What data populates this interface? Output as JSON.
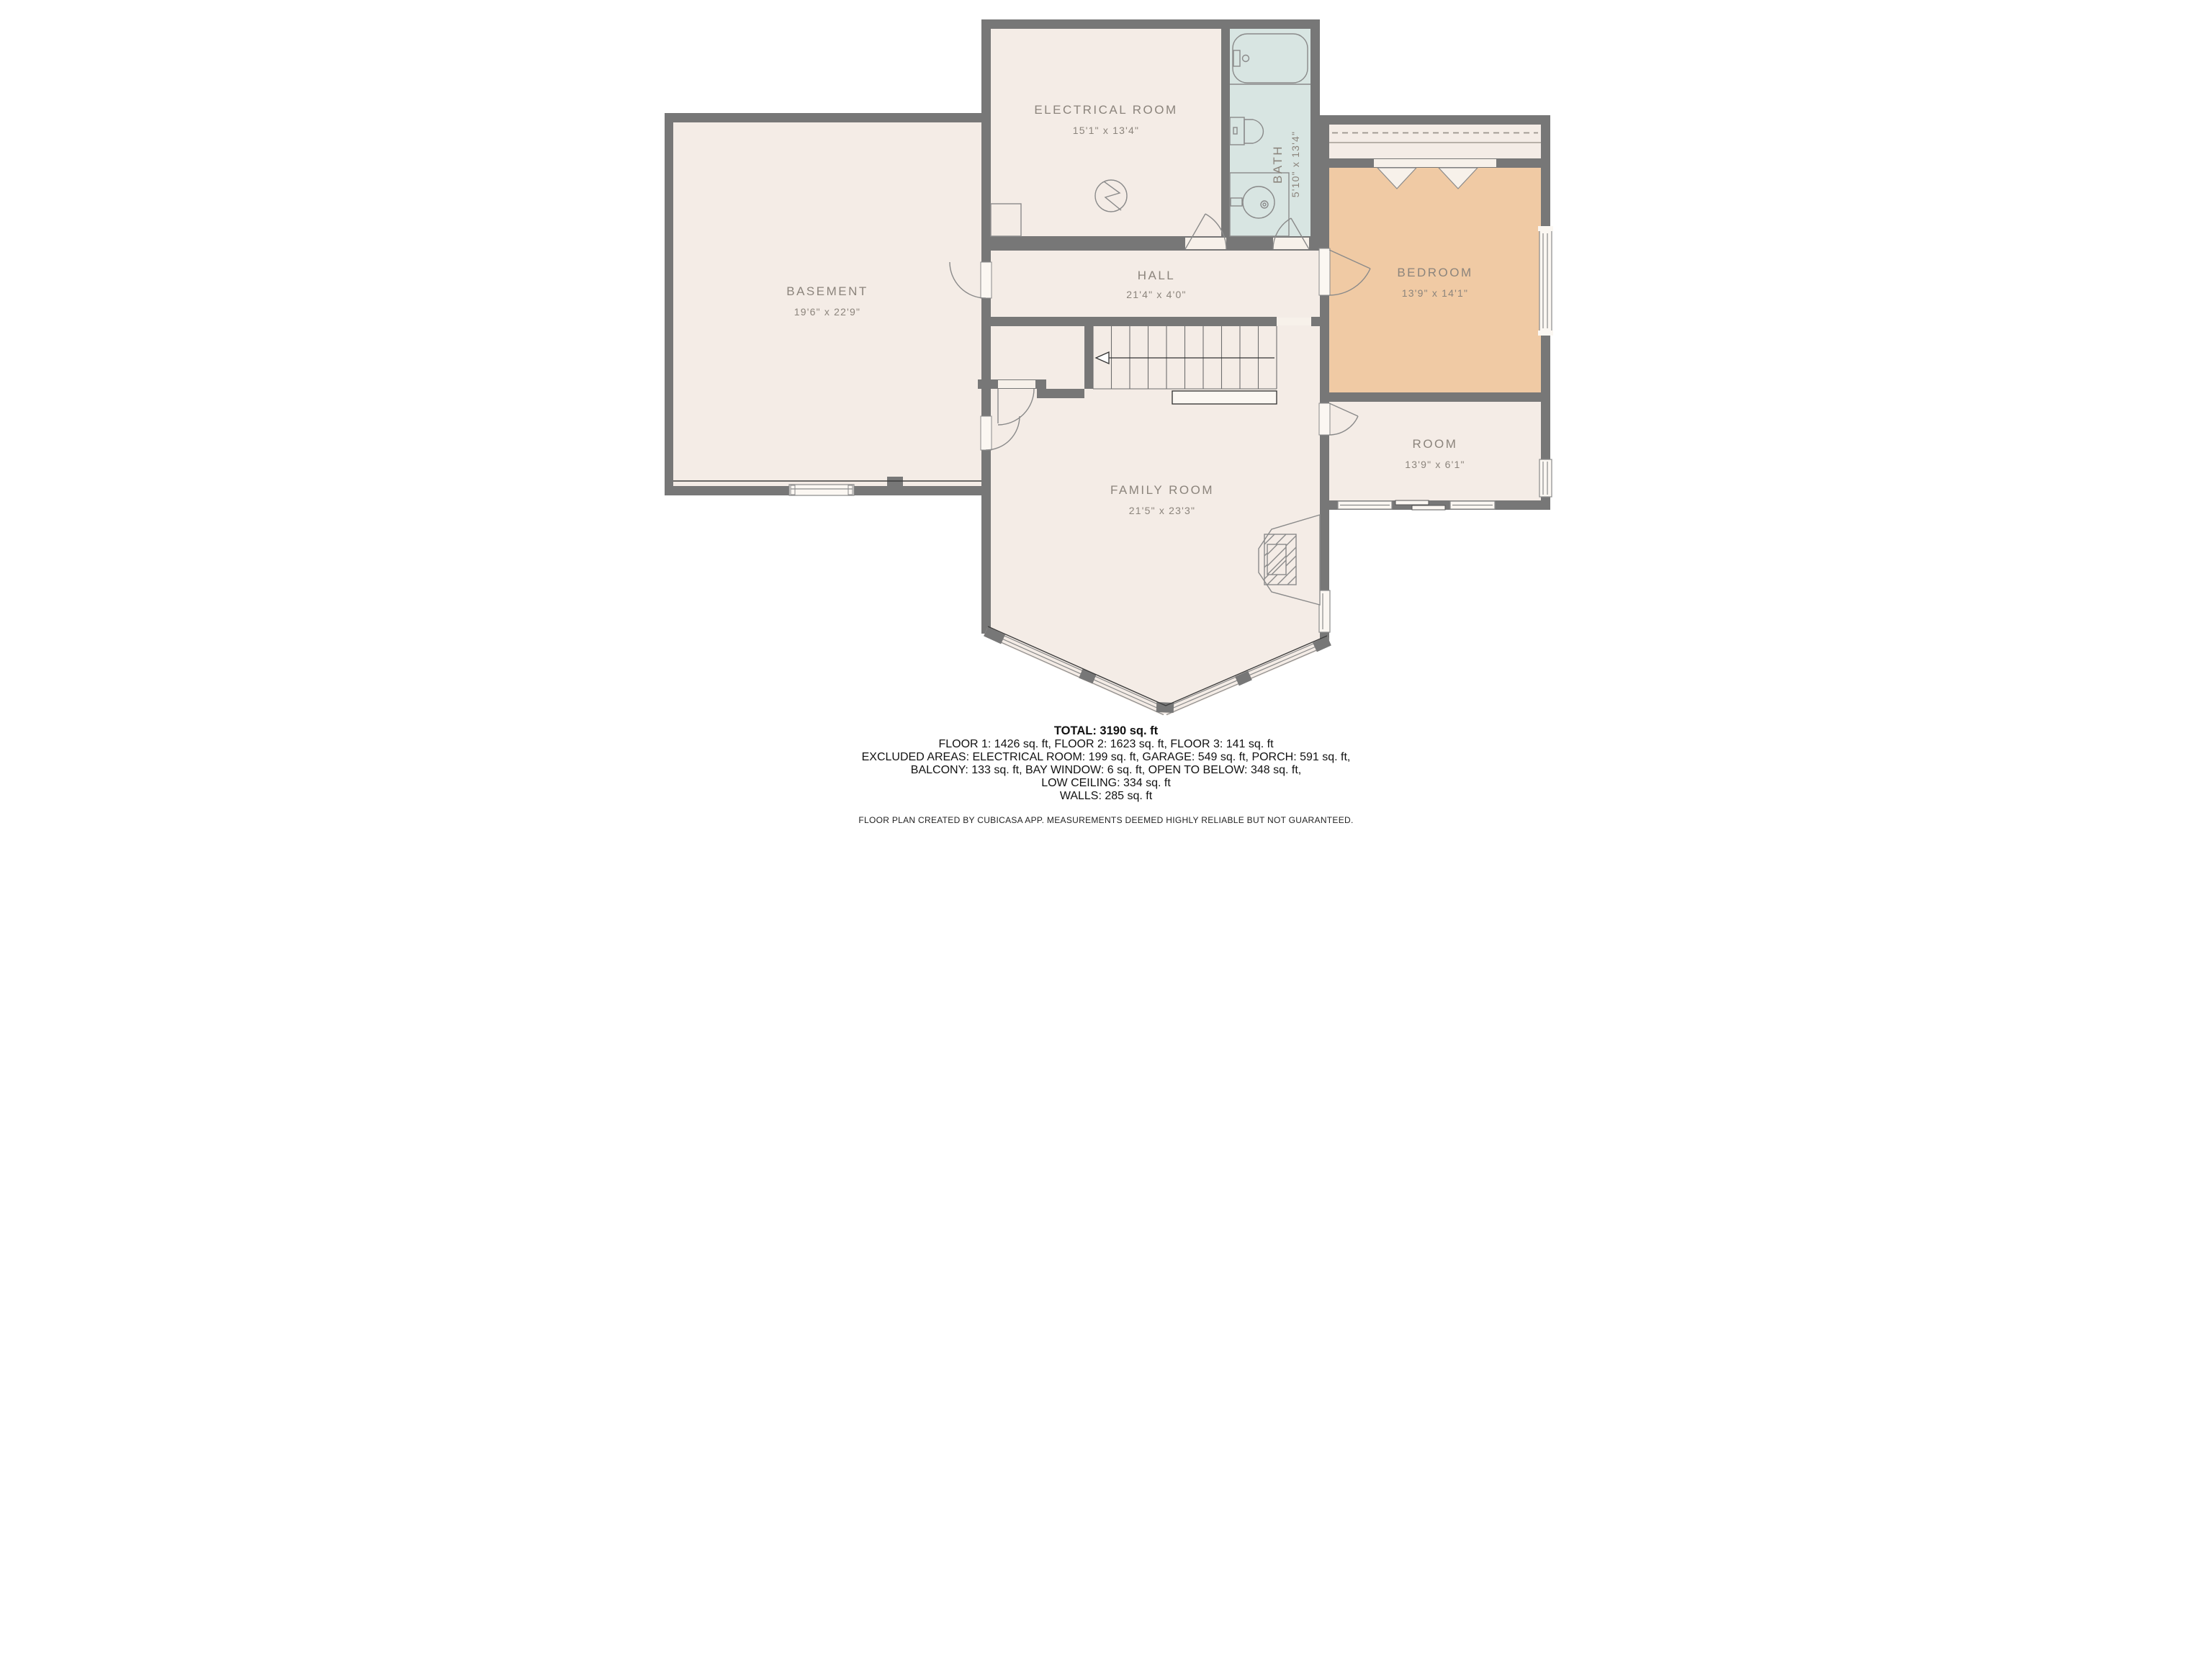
{
  "rooms": {
    "basement": {
      "label": "BASEMENT",
      "dims": "19'6\" x 22'9\""
    },
    "electrical": {
      "label": "ELECTRICAL ROOM",
      "dims": "15'1\" x 13'4\""
    },
    "bath": {
      "label": "BATH",
      "dims": "5'10\" x 13'4\""
    },
    "hall": {
      "label": "HALL",
      "dims": "21'4\" x 4'0\""
    },
    "bedroom": {
      "label": "BEDROOM",
      "dims": "13'9\" x 14'1\""
    },
    "room": {
      "label": "ROOM",
      "dims": "13'9\" x 6'1\""
    },
    "family_room": {
      "label": "FAMILY ROOM",
      "dims": "21'5\" x 23'3\""
    }
  },
  "summary": {
    "total": "TOTAL: 3190 sq. ft",
    "floors": "FLOOR 1: 1426 sq. ft, FLOOR 2: 1623 sq. ft, FLOOR 3: 141 sq. ft",
    "excluded_line1": "EXCLUDED AREAS: ELECTRICAL ROOM: 199 sq. ft, GARAGE: 549 sq. ft, PORCH: 591 sq. ft,",
    "excluded_line2": "BALCONY: 133 sq. ft, BAY WINDOW: 6 sq. ft, OPEN TO BELOW: 348 sq. ft,",
    "excluded_line3": "LOW CEILING: 334 sq. ft",
    "walls": "WALLS: 285 sq. ft",
    "disclaimer": "FLOOR PLAN CREATED BY CUBICASA APP. MEASUREMENTS DEEMED HIGHLY RELIABLE BUT NOT GUARANTEED."
  },
  "colors": {
    "wall": "#777777",
    "floor": "#F4ECE6",
    "bath_floor": "#D8E5E2",
    "bedroom_floor": "#F0CAA4",
    "window": "#FBF7F2",
    "label_text": "#8B847C",
    "summary_text": "#111111"
  }
}
